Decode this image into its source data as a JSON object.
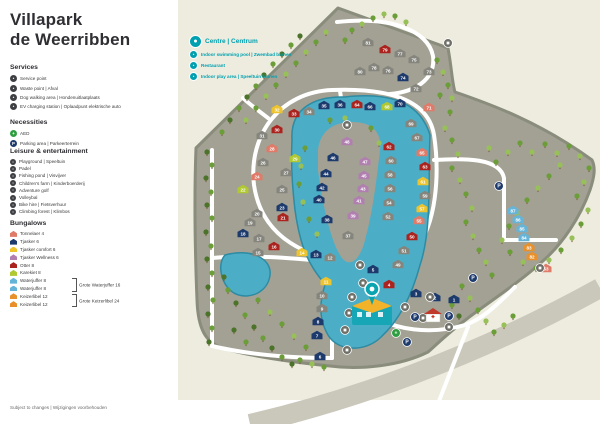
{
  "title_line1": "Villapark",
  "title_line2": "de Weerribben",
  "footer": "Subject to changes | Wijzigingen voorbehouden",
  "legend": {
    "services": {
      "header": "Services",
      "items": [
        {
          "label": "Service point",
          "icon": "service-point-icon",
          "color": "#3f4044"
        },
        {
          "label": "Waste point | Afval",
          "icon": "waste-point-icon",
          "color": "#3f4044"
        },
        {
          "label": "Dog walking area | Hondenuitlaatplaats",
          "icon": "dog-walking-icon",
          "color": "#3f4044"
        },
        {
          "label": "EV charging station | Oplaadpunt elektrische auto",
          "icon": "ev-charging-icon",
          "color": "#3f4044"
        }
      ]
    },
    "necessities": {
      "header": "Necessities",
      "items": [
        {
          "label": "AED",
          "icon": "aed-icon",
          "color": "#2f9e41"
        },
        {
          "label": "Parking area | Parkeerterrein",
          "icon": "parking-icon",
          "color": "#1d3a6d"
        }
      ]
    },
    "leisure": {
      "header": "Leisure & entertainment",
      "items": [
        {
          "label": "Playground | Speeltuin",
          "icon": "playground-icon",
          "color": "#3f4044"
        },
        {
          "label": "Padel",
          "icon": "padel-icon",
          "color": "#3f4044"
        },
        {
          "label": "Fishing pond | Visvijver",
          "icon": "fishing-icon",
          "color": "#3f4044"
        },
        {
          "label": "Children's farm | Kinderboerderij",
          "icon": "farm-icon",
          "color": "#3f4044"
        },
        {
          "label": "Adventure golf",
          "icon": "golf-icon",
          "color": "#3f4044"
        },
        {
          "label": "Volleybal",
          "icon": "volleyball-icon",
          "color": "#3f4044"
        },
        {
          "label": "Bike hire | Fietsverhuur",
          "icon": "bike-icon",
          "color": "#3f4044"
        },
        {
          "label": "Climbing forest | Klimbos",
          "icon": "climbing-icon",
          "color": "#3f4044"
        }
      ]
    },
    "bungalows": {
      "header": "Bungalows",
      "items": [
        {
          "label": "Tonnelaer 4",
          "type": "to"
        },
        {
          "label": "Tjasker 6",
          "type": "tj"
        },
        {
          "label": "Tjasker comfort 6",
          "type": "co"
        },
        {
          "label": "Tjasker Wellness 6",
          "type": "we"
        },
        {
          "label": "Otter 8",
          "type": "ot"
        },
        {
          "label": "Karekiet 8",
          "type": "ka"
        },
        {
          "label": "Waterjuffer 8",
          "type": "wa"
        },
        {
          "label": "Waterjuffer 8",
          "type": "wa"
        },
        {
          "label": "Keizerlibel 12",
          "type": "ke"
        },
        {
          "label": "Keizerlibel 12",
          "type": "ke"
        }
      ],
      "groups": [
        {
          "label": "Grote Waterjuffer 16",
          "rows": [
            6,
            7
          ]
        },
        {
          "label": "Grote Keizerlibel 24",
          "rows": [
            8,
            9
          ]
        }
      ]
    }
  },
  "map_key": {
    "title": "Centre | Centrum",
    "color": "#00a0b0",
    "items": [
      {
        "label": "Indoor swimming pool | Zwembad binnen",
        "icon": "swimming-pool-icon"
      },
      {
        "label": "Restaurant",
        "icon": "restaurant-icon"
      },
      {
        "label": "Indoor play area | Speeltuin binnen",
        "icon": "indoor-play-icon"
      }
    ]
  },
  "map": {
    "colors": {
      "background": "#edecdf",
      "land": "#a3a194",
      "land_edge": "#8a8c7c",
      "water": "#4caec6",
      "water_edge": "#2d8ba3",
      "road": "#ffffff",
      "outer_band": "#cac8bb",
      "tree_dark": "#4b7329",
      "tree_mid": "#6b9e38",
      "tree_light": "#97c158",
      "plain_marker": "#85857d",
      "to": "#df7b68",
      "tj": "#1d3a6d",
      "co": "#edc32e",
      "we": "#b07fb0",
      "ot": "#ab231e",
      "ka": "#b0c832",
      "wa": "#66b5d9",
      "ke": "#e8912c",
      "pl": "#85857d",
      "centre": "#0aa3b0",
      "parking": "#1d3a6d",
      "aed": "#2f9e41",
      "service": "#6f6f68"
    },
    "markers": [
      [
        1,
        "tj",
        454,
        299
      ],
      [
        2,
        "tj",
        435,
        297
      ],
      [
        3,
        "tj",
        416,
        293
      ],
      [
        4,
        "ot",
        389,
        284
      ],
      [
        5,
        "tj",
        373,
        269
      ],
      [
        6,
        "tj",
        320,
        356
      ],
      [
        7,
        "tj",
        317,
        335
      ],
      [
        8,
        "tj",
        318,
        321
      ],
      [
        9,
        "pl",
        322,
        308
      ],
      [
        10,
        "pl",
        322,
        295
      ],
      [
        11,
        "co",
        326,
        281
      ],
      [
        12,
        "pl",
        330,
        257
      ],
      [
        13,
        "tj",
        316,
        254
      ],
      [
        14,
        "co",
        302,
        252
      ],
      [
        15,
        "pl",
        258,
        252
      ],
      [
        16,
        "ot",
        274,
        246
      ],
      [
        17,
        "pl",
        259,
        238
      ],
      [
        18,
        "tj",
        243,
        233
      ],
      [
        19,
        "pl",
        250,
        222
      ],
      [
        20,
        "pl",
        257,
        213
      ],
      [
        21,
        "ot",
        283,
        217
      ],
      [
        22,
        "ka",
        243,
        189
      ],
      [
        23,
        "tj",
        282,
        207
      ],
      [
        24,
        "to",
        257,
        176
      ],
      [
        25,
        "pl",
        282,
        189
      ],
      [
        26,
        "pl",
        263,
        162
      ],
      [
        27,
        "pl",
        286,
        172
      ],
      [
        28,
        "to",
        272,
        148
      ],
      [
        29,
        "ka",
        295,
        158
      ],
      [
        30,
        "ot",
        277,
        129
      ],
      [
        31,
        "pl",
        262,
        135
      ],
      [
        32,
        "co",
        277,
        109
      ],
      [
        33,
        "ot",
        294,
        113
      ],
      [
        34,
        "pl",
        309,
        111
      ],
      [
        35,
        "tj",
        324,
        105
      ],
      [
        36,
        "tj",
        340,
        104
      ],
      [
        37,
        "pl",
        348,
        235
      ],
      [
        38,
        "tj",
        327,
        219
      ],
      [
        39,
        "we",
        353,
        215
      ],
      [
        40,
        "tj",
        319,
        199
      ],
      [
        41,
        "we",
        359,
        200
      ],
      [
        42,
        "tj",
        322,
        187
      ],
      [
        43,
        "we",
        363,
        188
      ],
      [
        44,
        "tj",
        326,
        173
      ],
      [
        45,
        "we",
        364,
        175
      ],
      [
        46,
        "tj",
        333,
        157
      ],
      [
        47,
        "we",
        365,
        161
      ],
      [
        48,
        "we",
        347,
        141
      ],
      [
        49,
        "pl",
        398,
        264
      ],
      [
        50,
        "ot",
        412,
        236
      ],
      [
        51,
        "pl",
        404,
        250
      ],
      [
        52,
        "pl",
        388,
        216
      ],
      [
        53,
        "to",
        546,
        268
      ],
      [
        54,
        "pl",
        389,
        202
      ],
      [
        55,
        "to",
        419,
        220
      ],
      [
        56,
        "pl",
        390,
        188
      ],
      [
        57,
        "co",
        422,
        208
      ],
      [
        58,
        "pl",
        390,
        174
      ],
      [
        59,
        "pl",
        425,
        195
      ],
      [
        60,
        "pl",
        391,
        160
      ],
      [
        61,
        "co",
        423,
        181
      ],
      [
        62,
        "ot",
        389,
        146
      ],
      [
        63,
        "ot",
        425,
        166
      ],
      [
        64,
        "ot",
        357,
        104
      ],
      [
        65,
        "to",
        422,
        152
      ],
      [
        66,
        "tj",
        370,
        106
      ],
      [
        67,
        "pl",
        417,
        137
      ],
      [
        68,
        "ka",
        387,
        106
      ],
      [
        69,
        "pl",
        411,
        123
      ],
      [
        70,
        "tj",
        400,
        103
      ],
      [
        71,
        "to",
        429,
        107
      ],
      [
        72,
        "pl",
        416,
        88
      ],
      [
        73,
        "pl",
        429,
        71
      ],
      [
        74,
        "tj",
        403,
        77
      ],
      [
        75,
        "pl",
        414,
        59
      ],
      [
        76,
        "pl",
        388,
        70
      ],
      [
        77,
        "pl",
        400,
        53
      ],
      [
        78,
        "pl",
        374,
        67
      ],
      [
        79,
        "ot",
        385,
        49
      ],
      [
        80,
        "pl",
        360,
        71
      ],
      [
        81,
        "pl",
        368,
        42
      ],
      [
        82,
        "ke",
        532,
        256
      ],
      [
        83,
        "ke",
        529,
        247
      ],
      [
        84,
        "wa",
        524,
        237
      ],
      [
        85,
        "wa",
        522,
        228
      ],
      [
        86,
        "wa",
        518,
        219
      ],
      [
        87,
        "wa",
        513,
        210
      ]
    ],
    "parking": [
      [
        373,
        293
      ],
      [
        415,
        317
      ],
      [
        449,
        316
      ],
      [
        407,
        342
      ],
      [
        473,
        278
      ],
      [
        499,
        186
      ]
    ],
    "services": [
      [
        448,
        43
      ],
      [
        360,
        265
      ],
      [
        363,
        283
      ],
      [
        352,
        297
      ],
      [
        349,
        313
      ],
      [
        345,
        330
      ],
      [
        405,
        307
      ],
      [
        423,
        318
      ],
      [
        449,
        327
      ],
      [
        540,
        268
      ],
      [
        347,
        125
      ],
      [
        347,
        350
      ],
      [
        430,
        297
      ]
    ],
    "aed": [
      [
        396,
        333
      ]
    ],
    "centre_pin": [
      372,
      289
    ],
    "first_aid_house": [
      433,
      315
    ],
    "roundabout": [
      352,
      263
    ]
  }
}
